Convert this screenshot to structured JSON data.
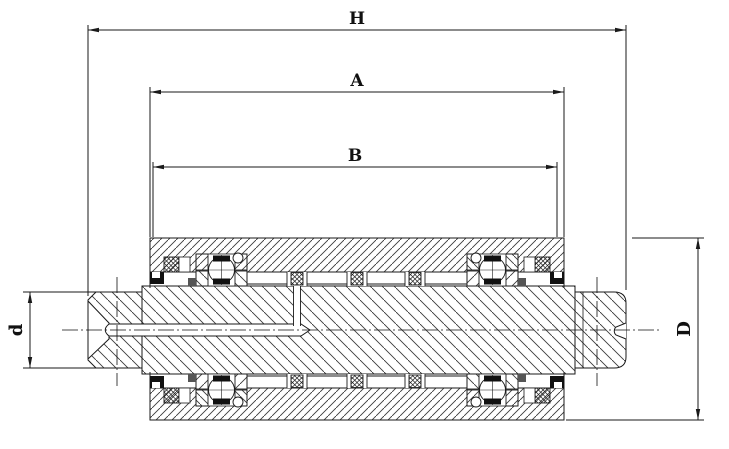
{
  "drawing": {
    "kind": "engineering-section-drawing",
    "subject": "roller-bearing-assembly-cross-section"
  },
  "dims": {
    "H": {
      "label": "H"
    },
    "A": {
      "label": "A"
    },
    "B": {
      "label": "B"
    },
    "d": {
      "label": "d"
    },
    "D": {
      "label": "D"
    }
  },
  "colors": {
    "line": "#1a1a1a",
    "hatch": "#3a3a3a",
    "seal_black": "#111111",
    "retainer_gray": "#555555",
    "background": "#ffffff"
  }
}
